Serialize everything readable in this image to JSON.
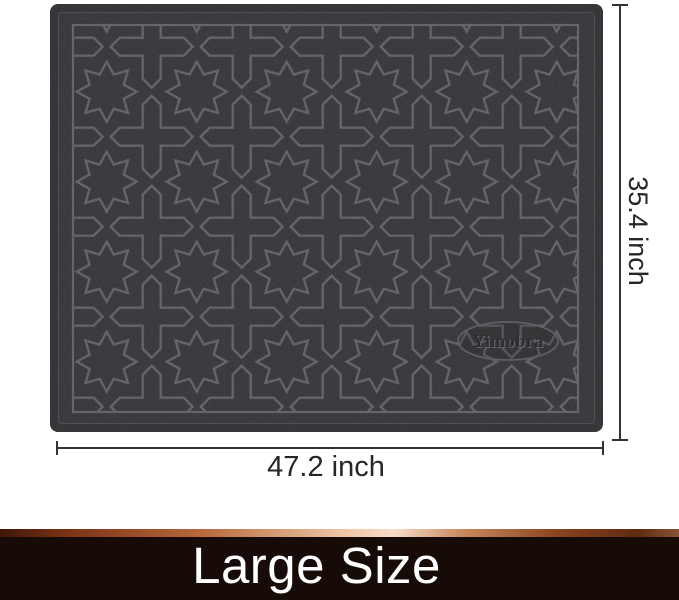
{
  "figure": {
    "brand": "Yimobra",
    "width_label": "47.2 inch",
    "height_label": "35.4 inch",
    "subject": "black doormat with embossed star-and-cross quatrefoil pattern"
  },
  "banner": {
    "label": "Large Size"
  },
  "colors": {
    "background": "#ffffff",
    "mat_edge": "#1e1e22",
    "mat_field": "#242428",
    "pattern_line": "#55555e",
    "logo_text": "#141417",
    "annotation": "#323232",
    "banner_bg": "#170b07",
    "banner_text": "#ffffff"
  }
}
